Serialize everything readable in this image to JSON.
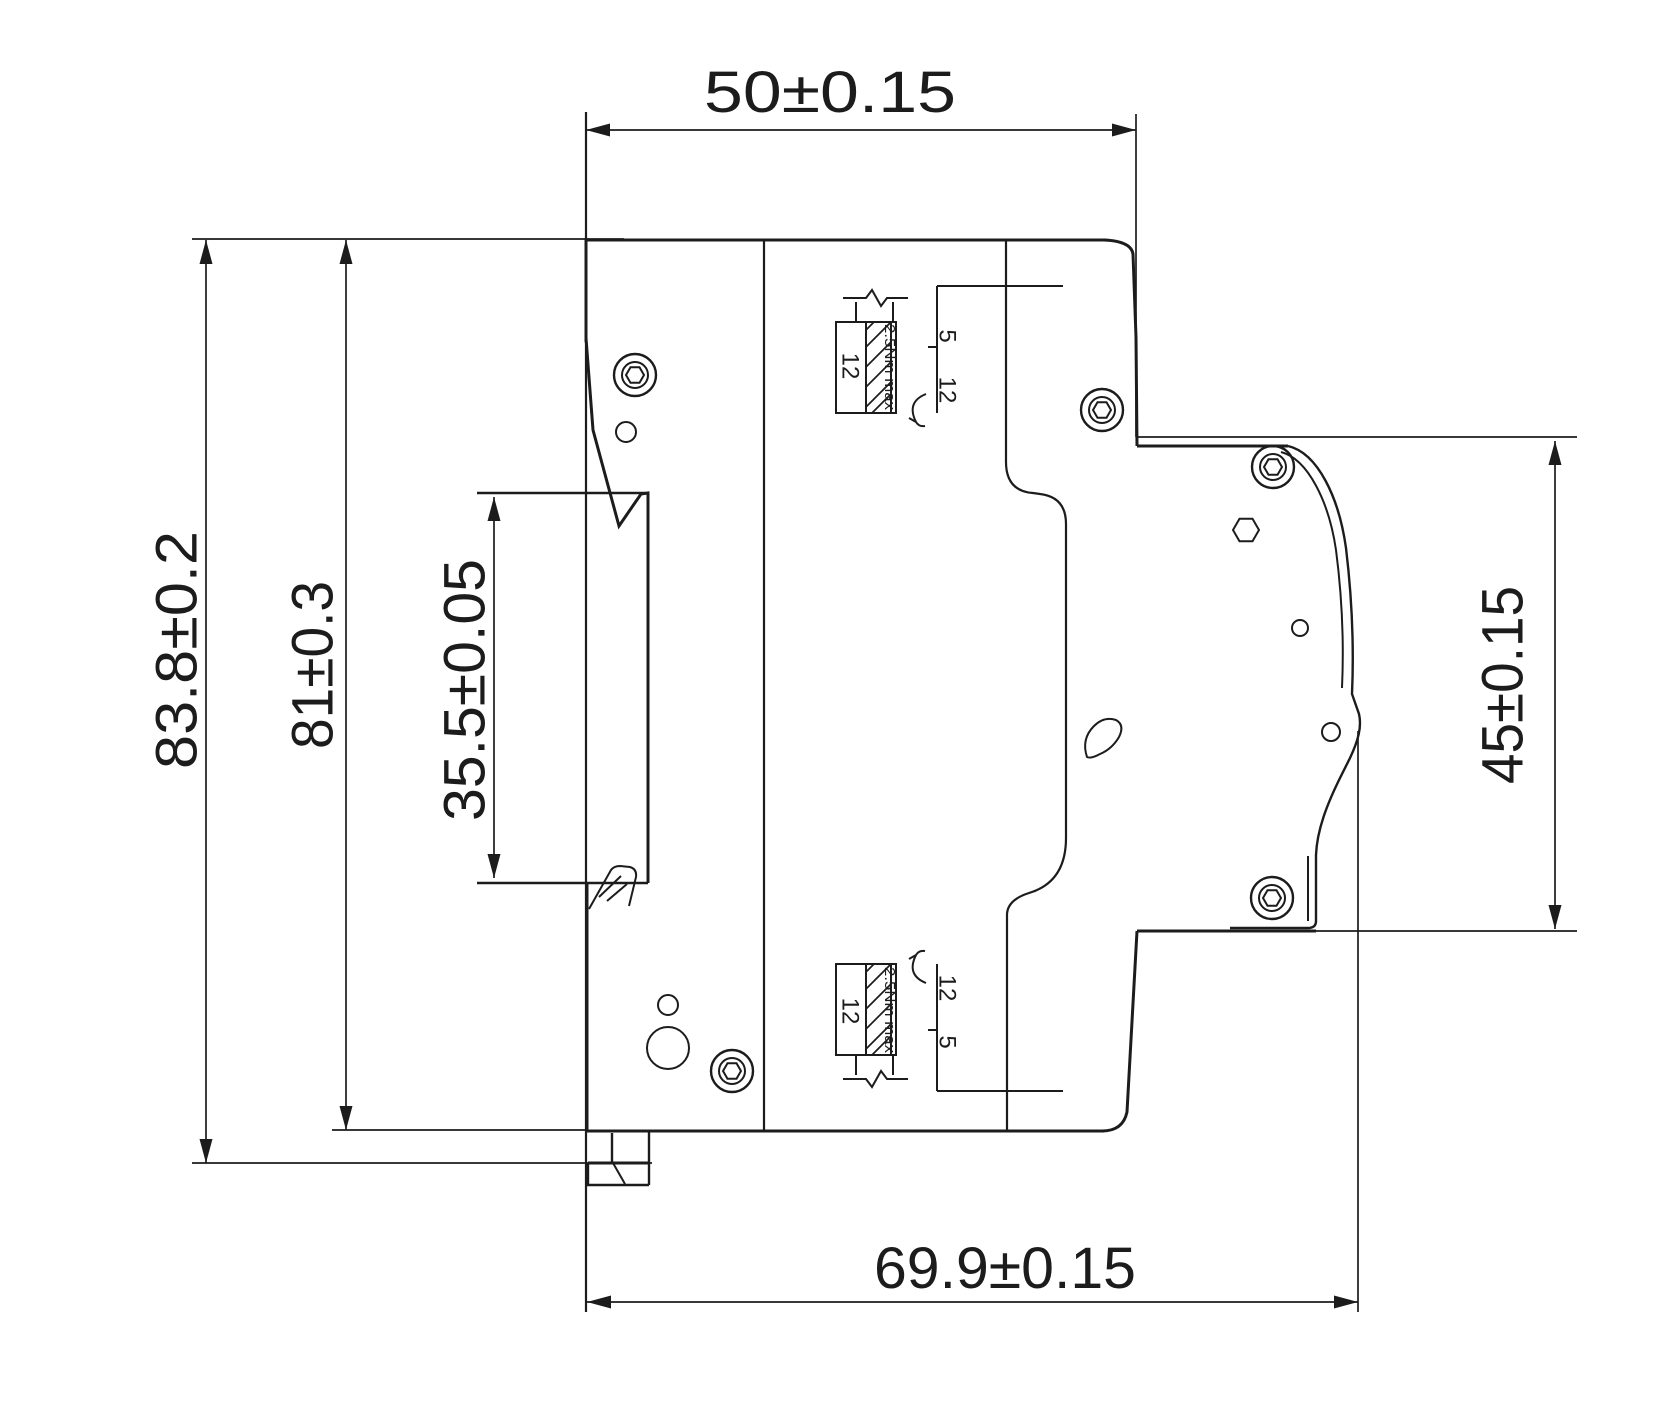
{
  "drawing_type": "dimensional engineering drawing, side view of DIN-rail circuit breaker",
  "dimensions": {
    "width_top": "50±0.15",
    "height_overall": "83.8±0.2",
    "height_body": "81±0.3",
    "height_din_slot": "35.5±0.05",
    "height_front": "45±0.15",
    "depth_bottom": "69.9±0.15"
  },
  "terminal_details": {
    "top": {
      "strip_length": "12",
      "torque": "2.5Nm max",
      "mark_upper": "5",
      "mark_lower": "12"
    },
    "bottom": {
      "strip_length": "12",
      "torque": "2.5Nm max",
      "mark_upper": "12",
      "mark_lower": "5"
    }
  },
  "colors": {
    "line": "#1c1c1c",
    "background": "#ffffff"
  }
}
